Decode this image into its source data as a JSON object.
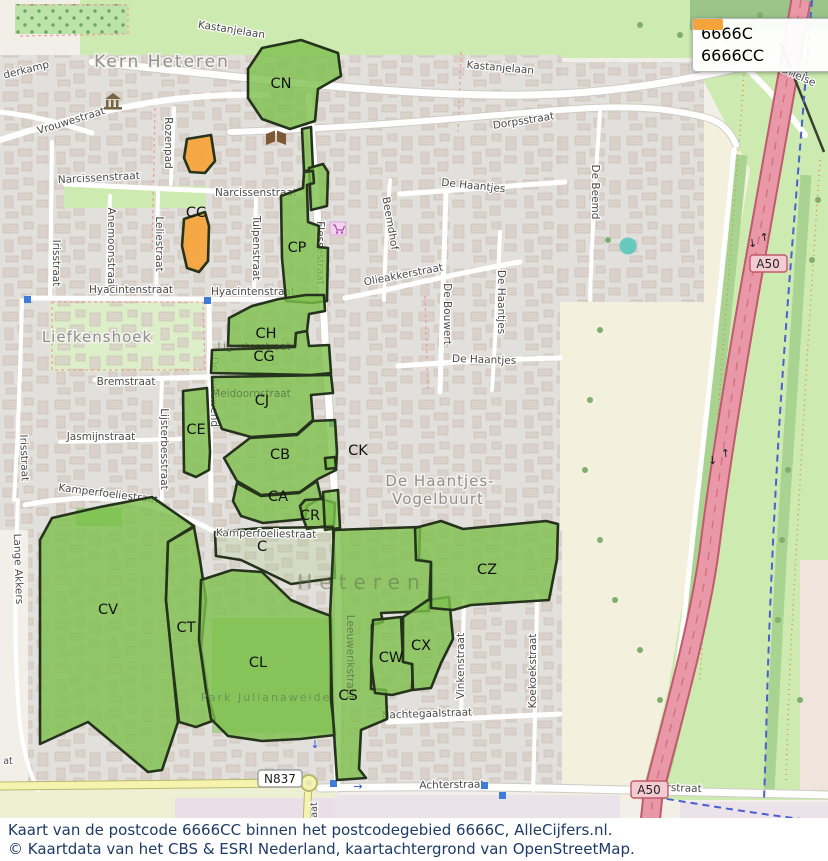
{
  "legend": {
    "items": [
      {
        "label": "6666C",
        "color": "#7dc04c"
      },
      {
        "label": "6666CC",
        "color": "#f5a43c"
      }
    ]
  },
  "caption": {
    "line1": "Kaart van de postcode 6666CC binnen het postcodegebied 6666C, AlleCijfers.nl.",
    "line2": "© Kaartdata van het CBS & ESRI Nederland, kaartachtergrond van OpenStreetMap."
  },
  "badges": {
    "n837": "N837",
    "a50": "A50"
  },
  "places": {
    "kern_heteren": "Kern Heteren",
    "liefkenshoek": "Liefkenshoek",
    "vogelbuurt_1": "De Haantjes-",
    "vogelbuurt_2": "Vogelbuurt",
    "heteren": "Heteren",
    "park_julianaweide": "Park Julianaweide"
  },
  "region_codes": {
    "cn": "CN",
    "cc": "CC",
    "cp": "CP",
    "ch": "CH",
    "cg": "CG",
    "cj": "CJ",
    "ce": "CE",
    "cb": "CB",
    "ck": "CK",
    "ca": "CA",
    "cr": "CR",
    "c": "C",
    "cv": "CV",
    "ct": "CT",
    "cl": "CL",
    "cs": "CS",
    "cw": "CW",
    "cx": "CX",
    "cz": "CZ"
  },
  "streets": {
    "kastanjelaan": "Kastanjelaan",
    "dorpsstraat": "Dorpsstraat",
    "drielse": "Drielse",
    "vrouwestraat": "Vrouwestraat",
    "derkamp": "derkamp",
    "rozenpad": "Rozenpad",
    "narcissenstraat": "Narcissenstraat",
    "irisstraat": "Irisstraat",
    "anemoonstraat": "Anemoonstraat",
    "leliestraat": "Leliestraat",
    "tulpenstraat": "Tulpenstraat",
    "hyacintenstraat": "Hyacintenstraat",
    "bremstraat": "Bremstraat",
    "jasmijnstraat": "Jasmijnstraat",
    "lijsterbesstraat": "Lijsterbesstraat",
    "de_nieuwend": "De Nieuwend",
    "meidoornstraat": "Meidoornstraat",
    "ligusterstraat": "Ligusterstraat",
    "flessestraat": "Flessestraat",
    "beemdhof": "Beemdhof",
    "olieakkerstraat": "Olieakkerstraat",
    "de_bouwert": "De Bouwert",
    "de_beemd": "De Beemd",
    "de_haantjes": "De Haantjes",
    "kamperfoeliestraat": "Kamperfoeliestraat",
    "lange_akkers": "Lange Akkers",
    "leeuwerikstraat": "Leeuwerikstraat",
    "nachtegaalstraat": "Nachtegaalstraat",
    "vinkenstraat": "Vinkenstraat",
    "koekoekstraat": "Koekoekstraat",
    "achterstraat": "Achterstraat",
    "fragment_aat": "aat",
    "fragment_at": "at"
  }
}
